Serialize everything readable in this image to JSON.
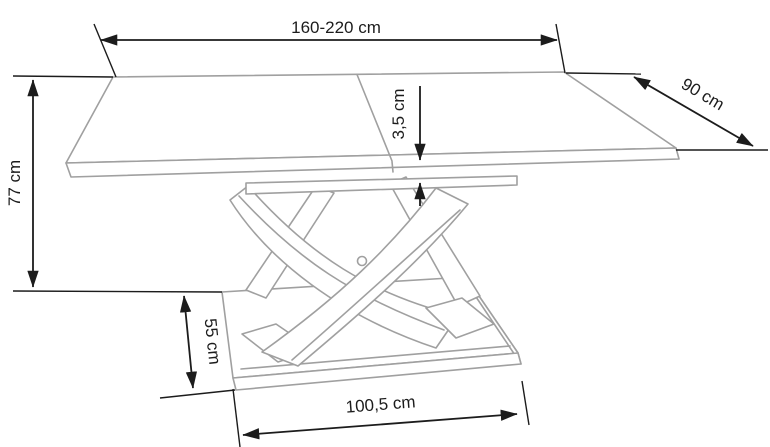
{
  "diagram": {
    "kind": "furniture-dimension-drawing",
    "colors": {
      "background": "#ffffff",
      "outline": "#a0a0a0",
      "dimension": "#1c1c1c"
    }
  },
  "dimensions": {
    "length": {
      "label": "160-220 cm",
      "min_cm": 160,
      "max_cm": 220
    },
    "depth": {
      "label": "90 cm",
      "value_cm": 90
    },
    "height": {
      "label": "77 cm",
      "value_cm": 77
    },
    "top_thickness": {
      "label": "3,5 cm",
      "value_cm": 3.5
    },
    "base_depth": {
      "label": "55 cm",
      "value_cm": 55
    },
    "base_width": {
      "label": "100,5 cm",
      "value_cm": 100.5
    }
  }
}
